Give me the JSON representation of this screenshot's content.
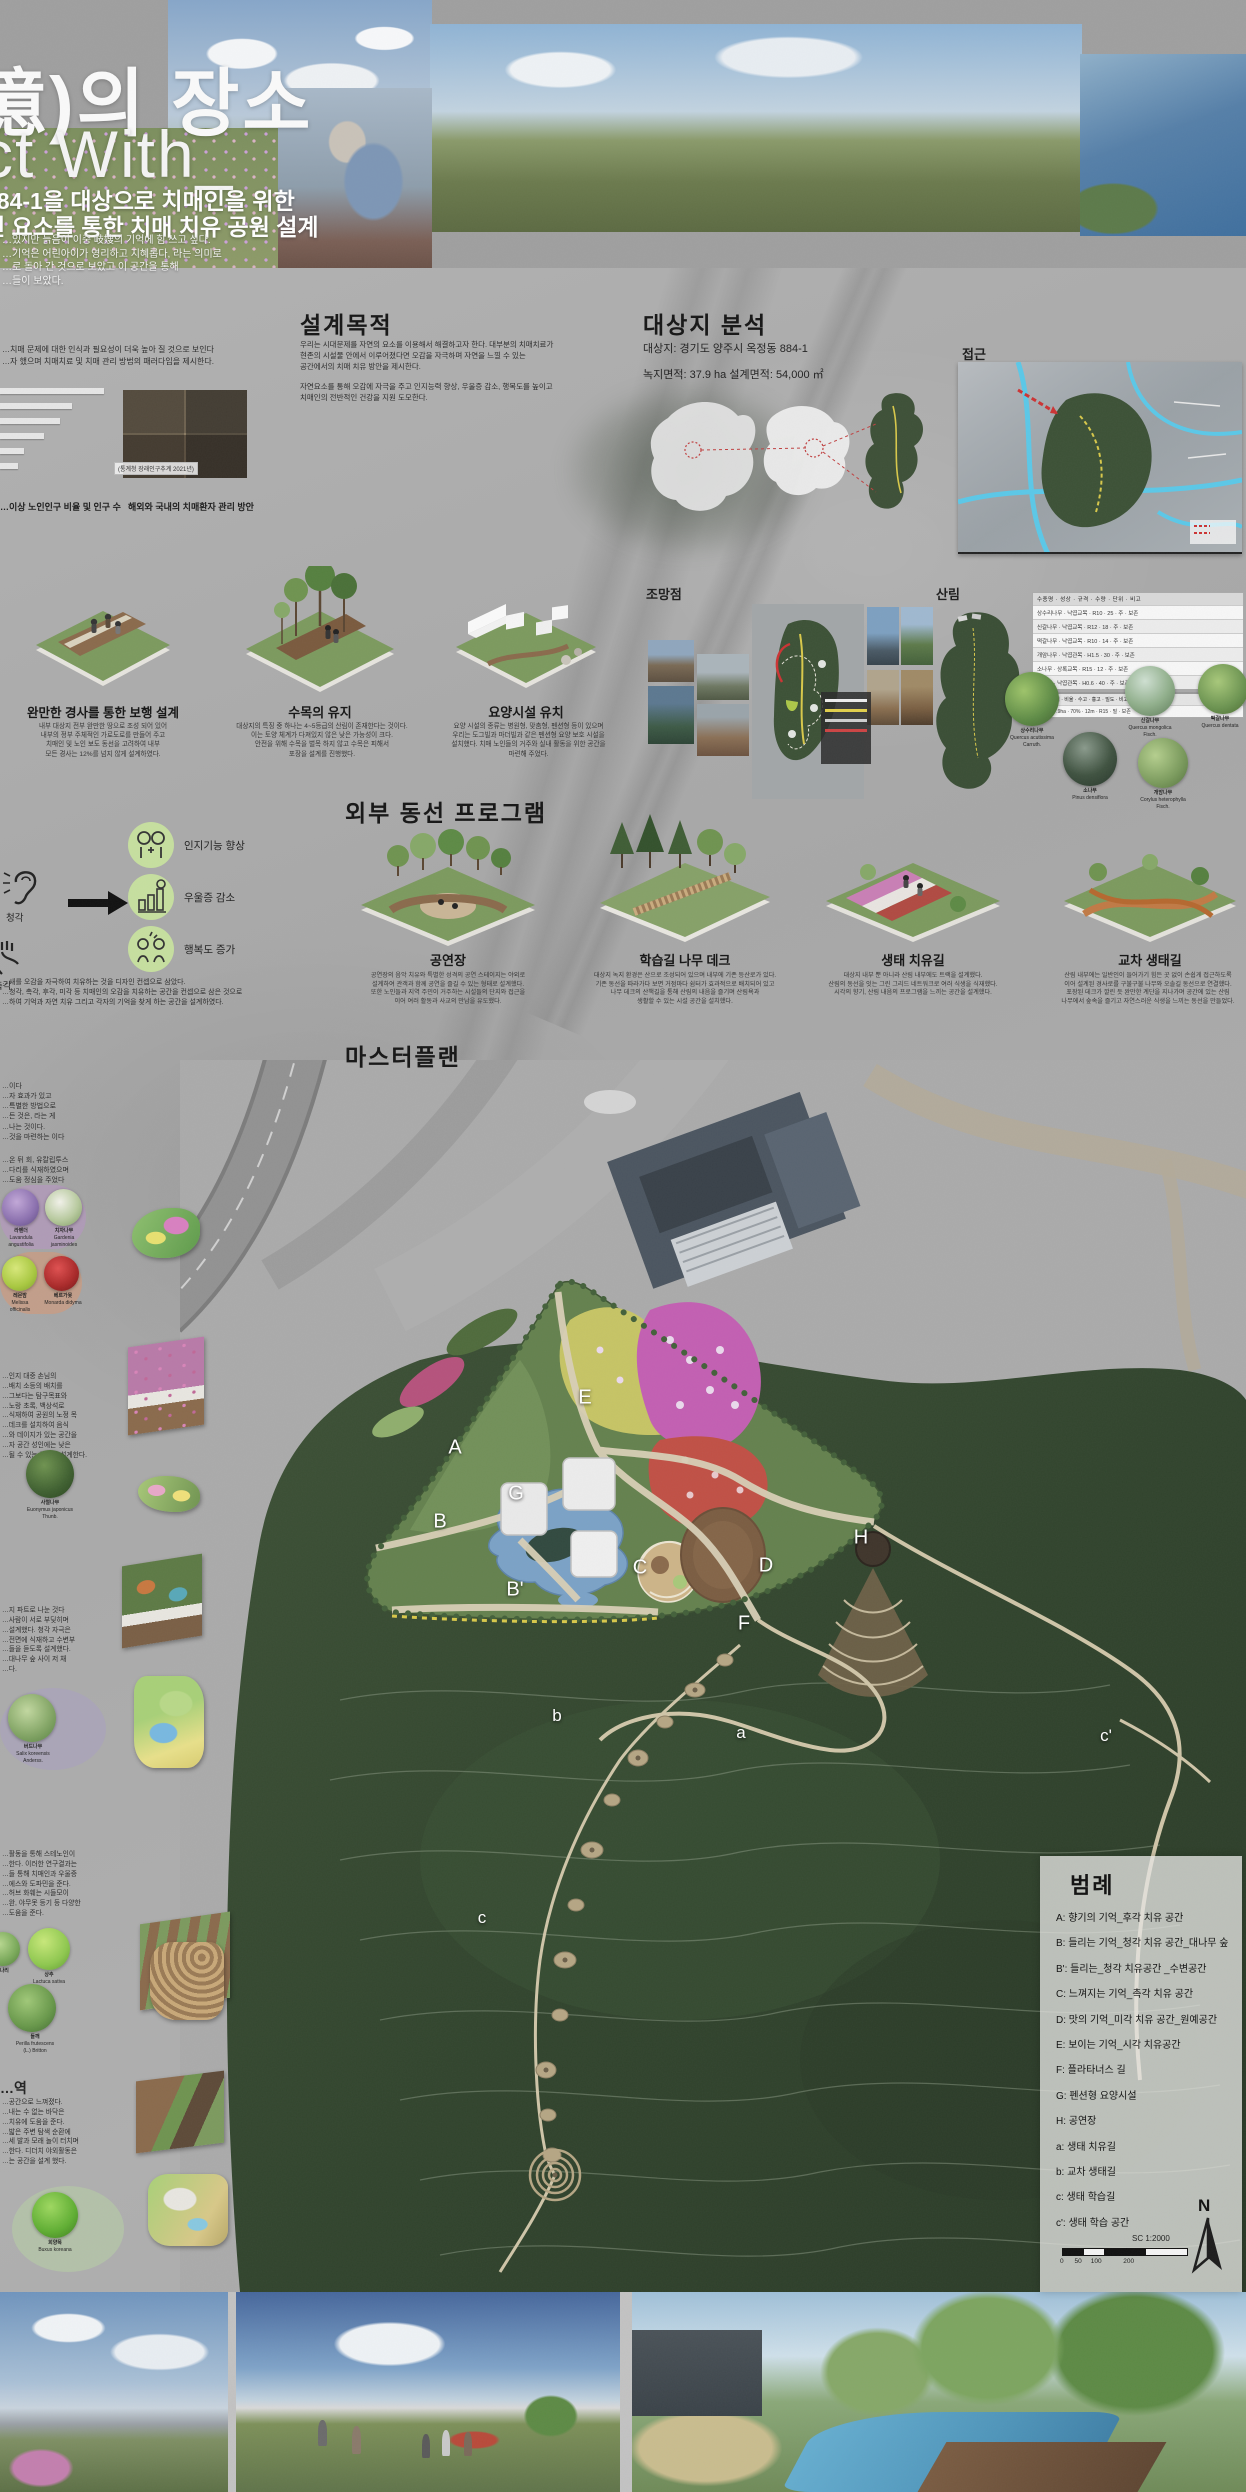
{
  "banner": {
    "title_kr": "憶)의 장소",
    "title_en": "ct With_",
    "sub1": "884-1을 대상으로 치매인을 위한",
    "sub2": "연 요소를 통한 치매 치유 공원 설계",
    "intro": "…있지만 늙음이 이중 岐嫂의 기억에 힘 쓰고 싶다.\n…기억은 어린아이가 영리하고 지혜롭다, 라는 의미로\n…로 돌아 간 것으로 보았고 이 공간을 통해\n…들이 보았다."
  },
  "left_intro": {
    "para": "…치매 문제에 대한 인식과 필요성이 더욱 높아 질 것으로 보인다\n…자 했으며 치매치료 및 치매 관리 방법의 패러다임을 제시한다.",
    "chart_note": "(통계청 장래인구추계 2021년)",
    "cap_left": "…이상 노인인구 비율 및 인구 수",
    "cap_right": "해외와 국내의 치매환자 관리 방안"
  },
  "purpose": {
    "heading": "설계목적",
    "p1": "우리는 시대문제를 자연의 요소를 이용해서 해결하고자 한다. 대부분의 치매치료가\n현존의 시설물 안에서 이루어졌다면 오감을 자극하며 자연을 느낄 수 있는\n공간에서의 치매 치유 방안을 제시한다.",
    "p2": "자연요소를 통해 오감에 자극을 주고 인지능력 향상, 우울증 감소, 행복도를 높이고\n치매인의 전반적인 건강을 지원 도모한다."
  },
  "site": {
    "heading": "대상지 분석",
    "target": "대상지: 경기도 양주시 옥정동 884-1",
    "area": "녹지면적: 37.9 ha    설계면적: 54,000 ㎡",
    "access_label": "접근",
    "view_label": "조망점",
    "forest_label": "산림",
    "table_header": "수종명 · 성상 · 규격 · 수량 · 단위 · 비고",
    "table_rows": [
      "상수리나무 · 낙엽교목 · R10 · 25 · 주 · 보존",
      "신갈나무 · 낙엽교목 · R12 · 18 · 주 · 보존",
      "떡갈나무 · 낙엽교목 · R10 · 14 · 주 · 보존",
      "개암나무 · 낙엽관목 · H1.5 · 30 · 주 · 보존",
      "소나무 · 상록교목 · R15 · 12 · 주 · 보존",
      "진달래 · 낙엽관목 · H0.6 · 40 · 주 · 보존"
    ],
    "subtable_header": "구분 · 면적 · 비율 · 수고 · 흉고 · 밀도 · 비고",
    "subtable_row": "산림 · 37.9ha · 70% · 12m · R15 · 밀 · 보존",
    "species": [
      {
        "name": "상수리나무",
        "latin": "Quercus acutissima\nCarruth."
      },
      {
        "name": "신갈나무",
        "latin": "Quercus mongolica\nFisch."
      },
      {
        "name": "떡갈나무",
        "latin": "Quercus dentata"
      },
      {
        "name": "소나무",
        "latin": "Pinus densiflora"
      },
      {
        "name": "개암나무",
        "latin": "Corylus heterophylla\nFisch."
      }
    ]
  },
  "concepts": [
    {
      "title": "완만한 경사를 통한 보행 설계",
      "desc": "내부 대상지 전부 완만한 땅으로 조성 되어 있어\n내부의 정부 주체적인 가로도로를 만들어 주고\n치매인 및 노인 보도 동선을 고려하여 내부\n모든 경사는 12%를 넘지 않게 설계하였다."
    },
    {
      "title": "수목의 유지",
      "desc": "대상지의 특징 중 하나는 4~5등급의 산림이 존재한다는 것이다.\n이는 토양 체계가 다져있지 않은 낮은 가능성이 크다.\n안전을 위해 수목을 벌목 하지 않고 수목은 피해서\n포장을 설계를 진행했다."
    },
    {
      "title": "요양시설 유치",
      "desc": "요양 시설의 종류는 병원형, 맞춤형, 펜션형 등이 있으며\n우리는 도그빌과 마더빌과 같은 펜션형 요양 보호 시설을\n설치했다. 치매 노인들의 거주와 실내 활동을 위한 공간을\n마련해 주었다."
    }
  ],
  "benefits": {
    "sense1": "청각",
    "sense2": "촉각",
    "items": [
      "인지기능 향상",
      "우울증 감소",
      "행복도 증가"
    ],
    "note": "…새를 오감을 자극하여 치유하는 것을 디자인 컨셉으로 삼았다.\n…청각, 촉각, 후각, 미각 등 치매인의 오감을 치유하는 공간을 컨셉으로 삼은 것으로\n…하여 기억과 자연 치유 그리고 각자의 기억을 찾게 하는 공간을 설계하였다."
  },
  "programs": {
    "heading": "외부 동선 프로그램",
    "cards": [
      {
        "title": "공연장",
        "desc": "공연장의 음악 치유와 특별한 성격의 공연 스테이지는 야외로\n설계하여 관객과 함께 공연을 즐길 수 있는 형태로 설계했다.\n또한 노인들과 지역 주민이 거주하는 시설들의 단지와 접근을\n이어 여러 활동과 사교의 만남을 유도했다."
      },
      {
        "title": "학습길 나무 데크",
        "desc": "대상지 녹지 환경은 산으로 조성되어 있으며 내부에 기존 등산로가 있다.\n기존 동선을 따라가다 보면 거점마다 쉼터가 효과적으로 배치되어 있고\n나무 데크의 산책길을 통해 산림의 내음을 즐기며 산림욕과\n생활할 수 있는 시설 공간을 설치했다."
      },
      {
        "title": "생태 치유길",
        "desc": "대상지 내부 뿐 아니라 산림 내부에도 트랙을 설계했다.\n산림의 동선을 잇는 그린 그리드 네트워크로 여러 식생을 식재했다.\n시각의 향기, 산림 내음의 프로그램을 느끼는 공간을 설계했다."
      },
      {
        "title": "교차 생태길",
        "desc": "산림 내부에는 일반인이 들어가기 힘든 곳 없이 손쉽게 접근하도록\n이어 설계된 경사로를 구불구불 나무와 오솔길 동선으로 연결했다.\n포장된 데크가 깔린 듯 완만한 계단을 지나가며 공간에 있는 산림\n나무에서 숲속을 즐기고 자연스러운 식생을 느끼는 동선을 만들었다."
      }
    ]
  },
  "masterplan": {
    "heading": "마스터플랜",
    "labels": [
      "A",
      "B",
      "B'",
      "G",
      "E",
      "C",
      "D",
      "F",
      "H",
      "a",
      "b",
      "c",
      "c'"
    ]
  },
  "legend": {
    "title": "범례",
    "items": [
      "A: 향기의 기억_후각 치유 공간",
      "B: 들리는 기억_청각 치유 공간_대나무 숲",
      "B': 들리는_청각 치유공간 _수변공간",
      "C: 느껴지는 기억_촉각 치유 공간",
      "D: 맛의 기억_미각 치유 공간_원예공간",
      "E: 보이는 기억_시각 치유공간",
      "F: 플라타너스 길",
      "G: 펜션형 요양시설",
      "H: 공연장",
      "a: 생태 치유길",
      "b: 교차 생태길",
      "c: 생태 학습길",
      "c': 생태 학습 공간"
    ],
    "scale_label": "SC 1:2000",
    "scale_ticks": "0      50     100            200",
    "north": "N"
  },
  "leftcol": {
    "t1": "…이다\n…자 효과가 있고\n…특별한 방법으로\n…든 것은, 라는 게\n…나는 것이다.\n…것을 마련하는 이다",
    "t2": "…온 뒤 회, 유칼립투스\n…다리를 식재하였으며\n…도움 정심을 주었다",
    "herb1": {
      "name": "라벤더",
      "latin": "Lavandula\nangustifolia"
    },
    "herb2": {
      "name": "치자나무",
      "latin": "Gardenia\njasminoides"
    },
    "herb3": {
      "name": "레몬밤",
      "latin": "Melissa\nofficinalis"
    },
    "herb4": {
      "name": "베르가못",
      "latin": "Monarda didyma"
    },
    "t3": "…인지 대중 손님의\n…배치 소등의 배치를\n…그보다는 탐구목표와\n…노랑 초록, 백상석로\n…식재하여 공원의 노정 목\n…데크를 설치하여 음식\n…와 데이지가 있는 공간을\n…자 공간 성인에는 낮은\n…될 수 있는 통로를 설계한다.",
    "shrub1": {
      "name": "사철나무",
      "latin": "Euonymus japonicus\nThunb."
    },
    "t4": "…지 파트로 나눈 것다\n…사람이 서로 부딪히며\n…설계했다. 청각 자극은\n…전면에 식재하고 수변부\n…들을 듣도록 설계했다.\n…대나무 숲 사이 저 채\n…다.",
    "tree1": {
      "name": "버드나무",
      "latin": "Salix koreensis\nAnderss."
    },
    "t5": "…활동을 통해 스테노인이\n…한다. 이러한 연구결과는\n…들 통해 치매인과 우울증\n…에스와 도파민을 준다.\n…허브 화훼는 시들모이\n…완, 야무못 등기 등 다양한\n…도움을 준다.",
    "veg1": {
      "name": "상추",
      "latin": "Lactuca sativa"
    },
    "veg2": {
      "name": "들깨",
      "latin": "Perilla frutescens\n(L.) Britton"
    },
    "veg3": {
      "name": "미나리",
      "latin": "Oenanthe javanica"
    },
    "t6_head": "…역",
    "t6": "…공간으로 느껴졌다.\n…내는 수 없는 바닥은\n…치유에 도움을 준다.\n…밟은 주변 탐색 순환에\n…세 발과 모래 놀이 터치며\n…한다. 디더치 야외활동은\n…는 공간을 설계 했다.",
    "shrub2": {
      "name": "회양목",
      "latin": "Buxus koreana"
    }
  }
}
